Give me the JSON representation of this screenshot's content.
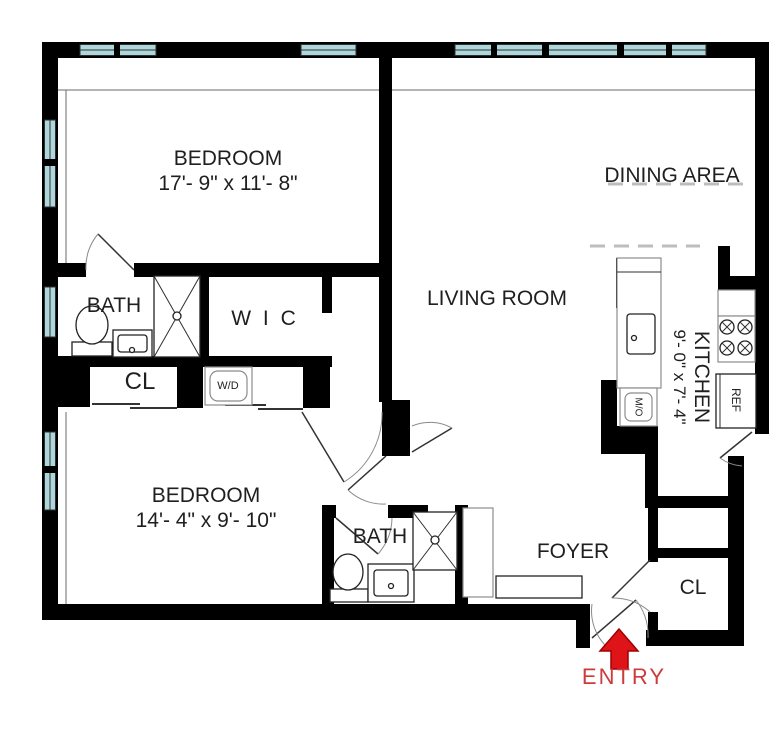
{
  "rooms": {
    "bedroom1": {
      "name": "BEDROOM",
      "dims": "17'- 9\" x 11'- 8\""
    },
    "bedroom2": {
      "name": "BEDROOM",
      "dims": "14'- 4\" x 9'- 10\""
    },
    "living": {
      "name": "LIVING ROOM"
    },
    "dining": {
      "name": "DINING AREA"
    },
    "kitchen": {
      "name": "KITCHEN",
      "dims": "9'- 0\" x 7'- 4\""
    },
    "bath1": {
      "name": "BATH"
    },
    "bath2": {
      "name": "BATH"
    },
    "wic": {
      "name": "W I C"
    },
    "closet1": {
      "name": "CL"
    },
    "closet2": {
      "name": "CL"
    },
    "foyer": {
      "name": "FOYER"
    }
  },
  "appliances": {
    "washer_dryer": "W/D",
    "micro_oven": "M/O",
    "refrigerator": "REF"
  },
  "entry": {
    "label": "ENTRY"
  },
  "colors": {
    "wall": "#000000",
    "window_glass": "#aed7db",
    "entry_red": "#df1418",
    "entry_text": "#cf3a3a",
    "label_text": "#1f1f1f"
  }
}
